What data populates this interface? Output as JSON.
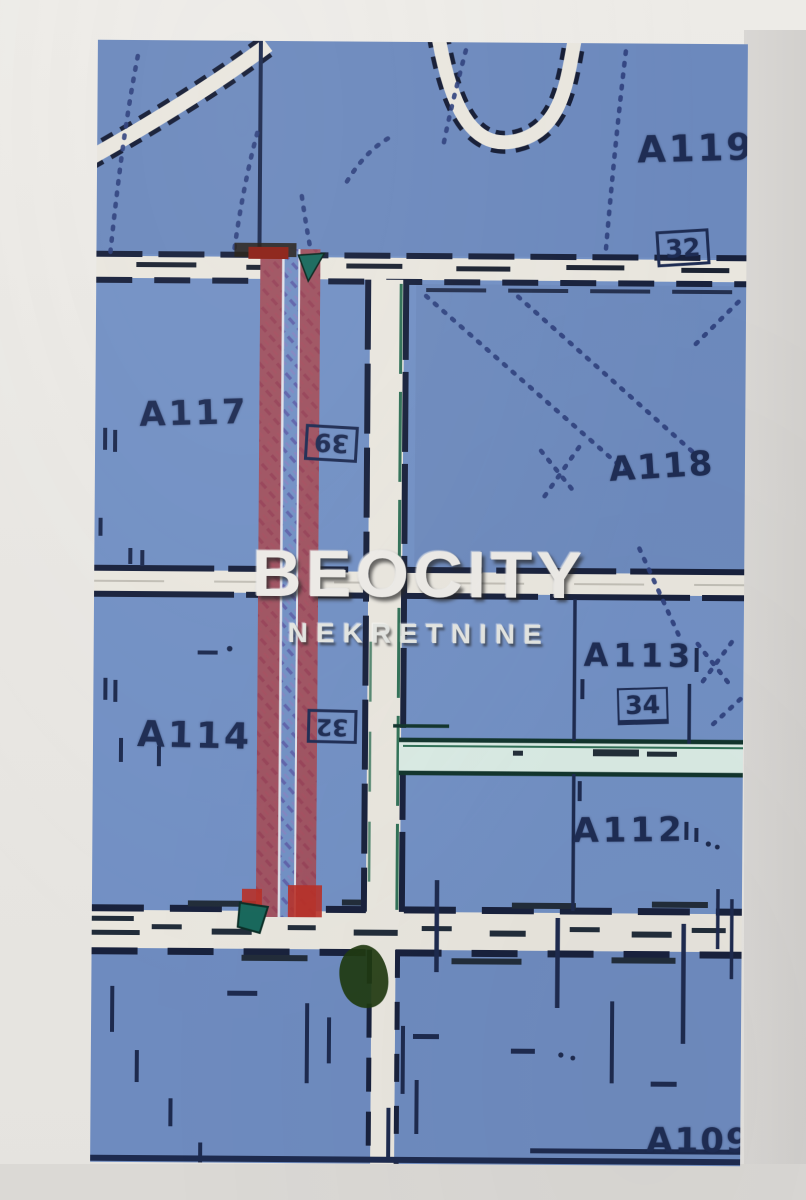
{
  "document_type": "scanned cadastral map photo",
  "watermark": {
    "brand": "BEOCITY",
    "subtitle": "NEKRETNINE"
  },
  "map": {
    "region_labels": [
      {
        "id": "a119",
        "text": "A119"
      },
      {
        "id": "a117",
        "text": "A117"
      },
      {
        "id": "a118",
        "text": "A118"
      },
      {
        "id": "a113",
        "text": "A113"
      },
      {
        "id": "a114",
        "text": "A114"
      },
      {
        "id": "a112",
        "text": "A112"
      },
      {
        "id": "a109",
        "text": "A109"
      }
    ],
    "plot_numbers": [
      {
        "position": "top-right",
        "text": "32"
      },
      {
        "position": "center-on-highlight",
        "text": "39"
      },
      {
        "position": "center-left-on-highlight",
        "text": "32"
      },
      {
        "position": "below-a113",
        "text": "34"
      }
    ],
    "highlighted_parcel": "long narrow strip outlined in red with hatched interior, between roads"
  },
  "colors": {
    "map_blue": "#7190c6",
    "road_white": "#e9e6de",
    "line_dark_navy": "#1c2a50",
    "highlight_red": "#bc2f26",
    "marker_teal": "#15695c",
    "teal_road_fill": "#d9ebe4",
    "vegetation_green": "#1e3a0e",
    "paper_margin": "#d9d7d4",
    "watermark_white": "#eceae6"
  }
}
